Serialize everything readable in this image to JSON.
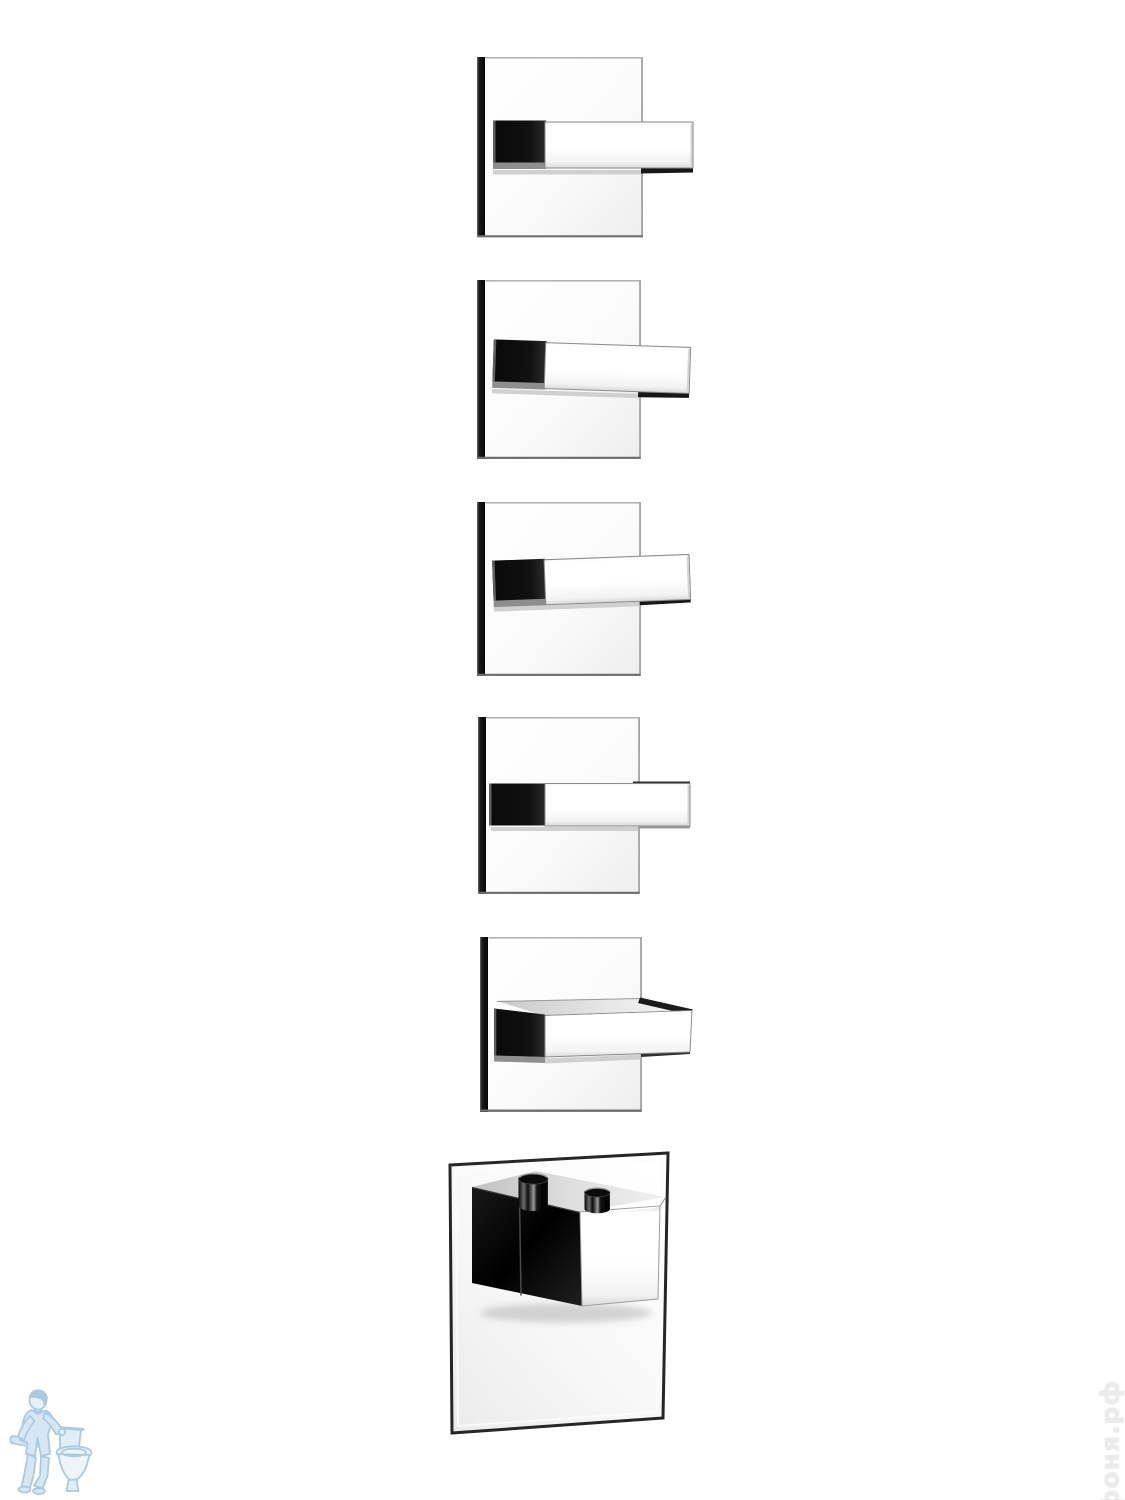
{
  "page": {
    "background_color": "#ffffff"
  },
  "scene": {
    "description": "chrome-square-shower-valve-trim-set-six-units",
    "units": [
      {
        "name": "square-valve-trim-1",
        "handle": "lever-level"
      },
      {
        "name": "square-valve-trim-2",
        "handle": "lever-tilted-down"
      },
      {
        "name": "square-valve-trim-3",
        "handle": "lever-tilted-up"
      },
      {
        "name": "square-valve-trim-4",
        "handle": "lever-level-front"
      },
      {
        "name": "square-valve-trim-5",
        "handle": "lever-top-face-visible"
      },
      {
        "name": "thermostatic-mixer-unit",
        "handle": "cube-knob-with-two-pins"
      }
    ],
    "colors": {
      "chrome_white": "#ffffff",
      "chrome_black": "#0d0d0d",
      "edge_gray": "#8b8b8b",
      "plate_shadow": "#c6c6c6"
    }
  },
  "watermarks": {
    "site": {
      "text": "афоня.рф",
      "color": "#ebebeb"
    },
    "logo": {
      "name": "plumber-with-toilet-logo",
      "stroke_color": "#9dc0da",
      "fill_color": "#cfe3f2"
    }
  }
}
